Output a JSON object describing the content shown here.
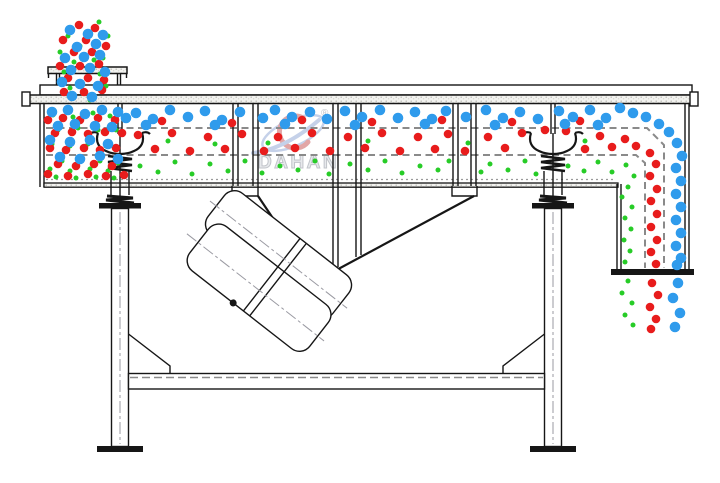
{
  "watermark": {
    "brand": "DAHAN",
    "registered": "®",
    "brand_color": "#e2e4e8",
    "logo_blue": "#b7c6e4",
    "logo_red": "#db9191"
  },
  "particles": {
    "colors": {
      "blue": "#2f9bec",
      "red": "#e81c1c",
      "green": "#27cc27"
    },
    "radii": {
      "blue": 5.3,
      "red": 4.3,
      "green": 2.5
    },
    "blue": [
      [
        70,
        30
      ],
      [
        88,
        34
      ],
      [
        103,
        35
      ],
      [
        77,
        47
      ],
      [
        96,
        44
      ],
      [
        65,
        58
      ],
      [
        84,
        57
      ],
      [
        100,
        55
      ],
      [
        71,
        70
      ],
      [
        90,
        68
      ],
      [
        105,
        72
      ],
      [
        62,
        82
      ],
      [
        80,
        84
      ],
      [
        98,
        86
      ],
      [
        72,
        96
      ],
      [
        92,
        97
      ],
      [
        52,
        112
      ],
      [
        68,
        110
      ],
      [
        85,
        114
      ],
      [
        102,
        110
      ],
      [
        118,
        112
      ],
      [
        58,
        126
      ],
      [
        75,
        124
      ],
      [
        95,
        126
      ],
      [
        112,
        127
      ],
      [
        50,
        140
      ],
      [
        70,
        142
      ],
      [
        90,
        140
      ],
      [
        108,
        144
      ],
      [
        60,
        157
      ],
      [
        80,
        159
      ],
      [
        100,
        156
      ],
      [
        118,
        159
      ],
      [
        126,
        118
      ],
      [
        136,
        113
      ],
      [
        153,
        119
      ],
      [
        170,
        110
      ],
      [
        188,
        117
      ],
      [
        205,
        111
      ],
      [
        222,
        120
      ],
      [
        240,
        112
      ],
      [
        263,
        118
      ],
      [
        275,
        110
      ],
      [
        292,
        117
      ],
      [
        310,
        112
      ],
      [
        327,
        119
      ],
      [
        345,
        111
      ],
      [
        362,
        117
      ],
      [
        380,
        110
      ],
      [
        398,
        118
      ],
      [
        415,
        112
      ],
      [
        432,
        119
      ],
      [
        446,
        111
      ],
      [
        466,
        117
      ],
      [
        486,
        110
      ],
      [
        503,
        118
      ],
      [
        520,
        112
      ],
      [
        538,
        119
      ],
      [
        559,
        111
      ],
      [
        573,
        117
      ],
      [
        590,
        110
      ],
      [
        606,
        118
      ],
      [
        146,
        125
      ],
      [
        215,
        125
      ],
      [
        285,
        124
      ],
      [
        355,
        125
      ],
      [
        425,
        124
      ],
      [
        495,
        125
      ],
      [
        565,
        124
      ],
      [
        598,
        125
      ],
      [
        620,
        108
      ],
      [
        633,
        113
      ],
      [
        646,
        117
      ],
      [
        659,
        124
      ],
      [
        669,
        132
      ],
      [
        677,
        143
      ],
      [
        682,
        156
      ],
      [
        676,
        168
      ],
      [
        681,
        181
      ],
      [
        676,
        194
      ],
      [
        681,
        207
      ],
      [
        676,
        220
      ],
      [
        681,
        233
      ],
      [
        676,
        246
      ],
      [
        681,
        258
      ],
      [
        677,
        265
      ],
      [
        678,
        283
      ],
      [
        673,
        298
      ],
      [
        680,
        313
      ],
      [
        675,
        327
      ]
    ],
    "red": [
      [
        79,
        25
      ],
      [
        95,
        28
      ],
      [
        63,
        40
      ],
      [
        86,
        40
      ],
      [
        106,
        46
      ],
      [
        74,
        52
      ],
      [
        92,
        52
      ],
      [
        60,
        66
      ],
      [
        80,
        66
      ],
      [
        99,
        64
      ],
      [
        68,
        78
      ],
      [
        88,
        78
      ],
      [
        104,
        80
      ],
      [
        64,
        92
      ],
      [
        84,
        92
      ],
      [
        102,
        90
      ],
      [
        48,
        120
      ],
      [
        63,
        118
      ],
      [
        80,
        120
      ],
      [
        98,
        118
      ],
      [
        115,
        120
      ],
      [
        55,
        133
      ],
      [
        72,
        132
      ],
      [
        88,
        134
      ],
      [
        105,
        132
      ],
      [
        122,
        133
      ],
      [
        50,
        148
      ],
      [
        66,
        150
      ],
      [
        84,
        148
      ],
      [
        100,
        150
      ],
      [
        116,
        148
      ],
      [
        58,
        164
      ],
      [
        76,
        166
      ],
      [
        94,
        164
      ],
      [
        112,
        166
      ],
      [
        48,
        174
      ],
      [
        68,
        176
      ],
      [
        88,
        174
      ],
      [
        106,
        176
      ],
      [
        124,
        175
      ],
      [
        162,
        121
      ],
      [
        232,
        123
      ],
      [
        302,
        120
      ],
      [
        372,
        122
      ],
      [
        442,
        120
      ],
      [
        512,
        122
      ],
      [
        580,
        121
      ],
      [
        138,
        135
      ],
      [
        155,
        149
      ],
      [
        172,
        133
      ],
      [
        190,
        151
      ],
      [
        208,
        137
      ],
      [
        225,
        149
      ],
      [
        242,
        134
      ],
      [
        264,
        151
      ],
      [
        278,
        137
      ],
      [
        295,
        148
      ],
      [
        312,
        133
      ],
      [
        330,
        151
      ],
      [
        348,
        137
      ],
      [
        365,
        148
      ],
      [
        382,
        133
      ],
      [
        400,
        151
      ],
      [
        418,
        137
      ],
      [
        435,
        149
      ],
      [
        448,
        134
      ],
      [
        465,
        151
      ],
      [
        488,
        137
      ],
      [
        505,
        148
      ],
      [
        522,
        133
      ],
      [
        545,
        130
      ],
      [
        566,
        131
      ],
      [
        585,
        149
      ],
      [
        600,
        136
      ],
      [
        612,
        147
      ],
      [
        625,
        139
      ],
      [
        636,
        146
      ],
      [
        650,
        153
      ],
      [
        656,
        164
      ],
      [
        650,
        176
      ],
      [
        657,
        189
      ],
      [
        651,
        201
      ],
      [
        657,
        214
      ],
      [
        651,
        227
      ],
      [
        657,
        240
      ],
      [
        651,
        252
      ],
      [
        656,
        264
      ],
      [
        652,
        283
      ],
      [
        658,
        295
      ],
      [
        650,
        307
      ],
      [
        656,
        319
      ],
      [
        651,
        329
      ]
    ],
    "green": [
      [
        99,
        22
      ],
      [
        68,
        36
      ],
      [
        108,
        36
      ],
      [
        80,
        46
      ],
      [
        60,
        52
      ],
      [
        103,
        58
      ],
      [
        74,
        62
      ],
      [
        94,
        60
      ],
      [
        64,
        72
      ],
      [
        100,
        74
      ],
      [
        70,
        88
      ],
      [
        106,
        86
      ],
      [
        90,
        100
      ],
      [
        53,
        115
      ],
      [
        73,
        117
      ],
      [
        93,
        113
      ],
      [
        110,
        116
      ],
      [
        58,
        130
      ],
      [
        78,
        128
      ],
      [
        98,
        130
      ],
      [
        116,
        130
      ],
      [
        52,
        144
      ],
      [
        70,
        146
      ],
      [
        88,
        144
      ],
      [
        106,
        146
      ],
      [
        62,
        161
      ],
      [
        82,
        159
      ],
      [
        100,
        161
      ],
      [
        118,
        163
      ],
      [
        50,
        169
      ],
      [
        70,
        171
      ],
      [
        90,
        169
      ],
      [
        108,
        171
      ],
      [
        56,
        177
      ],
      [
        76,
        178
      ],
      [
        96,
        177
      ],
      [
        114,
        178
      ],
      [
        168,
        141
      ],
      [
        215,
        144
      ],
      [
        268,
        143
      ],
      [
        368,
        141
      ],
      [
        468,
        143
      ],
      [
        585,
        141
      ],
      [
        140,
        166
      ],
      [
        158,
        172
      ],
      [
        175,
        162
      ],
      [
        192,
        174
      ],
      [
        210,
        164
      ],
      [
        228,
        171
      ],
      [
        245,
        161
      ],
      [
        262,
        173
      ],
      [
        280,
        166
      ],
      [
        298,
        170
      ],
      [
        315,
        161
      ],
      [
        329,
        174
      ],
      [
        350,
        164
      ],
      [
        368,
        170
      ],
      [
        385,
        161
      ],
      [
        402,
        173
      ],
      [
        420,
        166
      ],
      [
        438,
        170
      ],
      [
        449,
        161
      ],
      [
        481,
        172
      ],
      [
        490,
        164
      ],
      [
        508,
        170
      ],
      [
        525,
        161
      ],
      [
        536,
        174
      ],
      [
        568,
        166
      ],
      [
        584,
        171
      ],
      [
        598,
        162
      ],
      [
        612,
        172
      ],
      [
        626,
        165
      ],
      [
        634,
        176
      ],
      [
        628,
        187
      ],
      [
        622,
        197
      ],
      [
        632,
        207
      ],
      [
        625,
        218
      ],
      [
        631,
        229
      ],
      [
        624,
        240
      ],
      [
        630,
        251
      ],
      [
        625,
        262
      ],
      [
        628,
        281
      ],
      [
        622,
        293
      ],
      [
        632,
        303
      ],
      [
        625,
        315
      ],
      [
        633,
        325
      ]
    ]
  }
}
